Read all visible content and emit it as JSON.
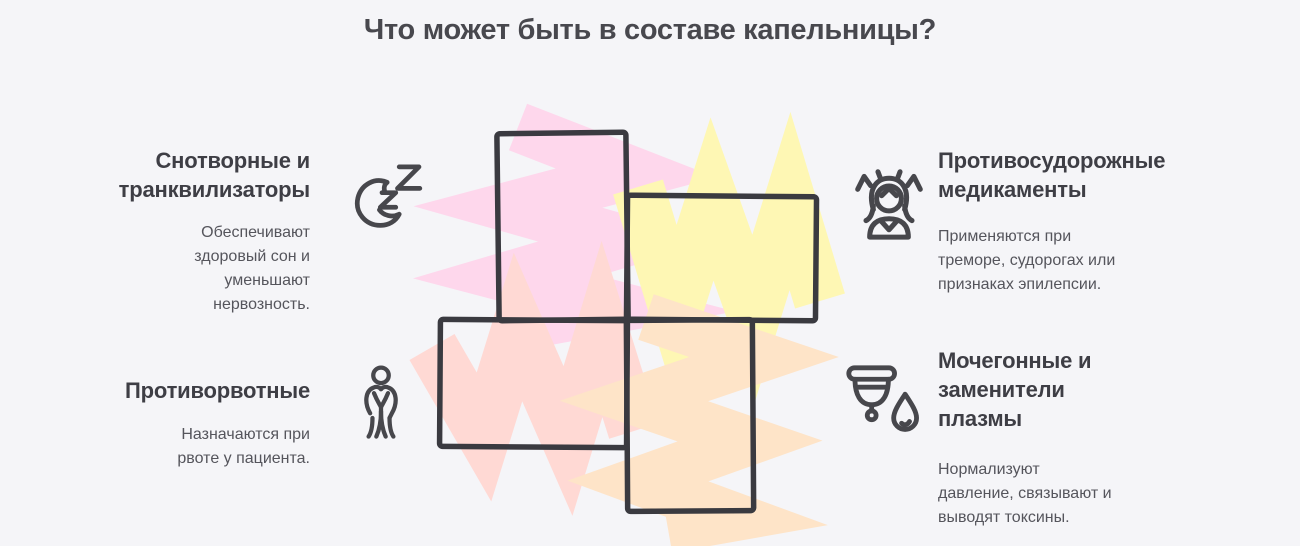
{
  "title": "Что может быть в составе капельницы?",
  "colors": {
    "background": "#f5f5f8",
    "outline": "#3a3a40",
    "heading_text": "#3e3e45",
    "body_text": "#55555c",
    "icon_stroke": "#47474c"
  },
  "sections": [
    {
      "id": "sedatives",
      "title": "Снотворные и транквилизаторы",
      "description": "Обеспечивают здоровый сон и уменьшают нервозность.",
      "icon": "moon-zzz-icon",
      "fill": "#fed7ec"
    },
    {
      "id": "anticonvulsants",
      "title": "Противосудорожные медикаменты",
      "description": "Применяются при треморе, судорогах или признаках эпилепсии.",
      "icon": "stressed-person-icon",
      "fill": "#fef7b4"
    },
    {
      "id": "antiemetics",
      "title": "Противорвотные",
      "description": "Назначаются при рвоте у пациента.",
      "icon": "nausea-person-icon",
      "fill": "#ffd9d4"
    },
    {
      "id": "diuretics",
      "title": "Мочегонные и заменители плазмы",
      "description": "Нормализуют давление, связывают и выводят токсины.",
      "icon": "diuretics-cup-drop-icon",
      "fill": "#fee4c8"
    }
  ]
}
